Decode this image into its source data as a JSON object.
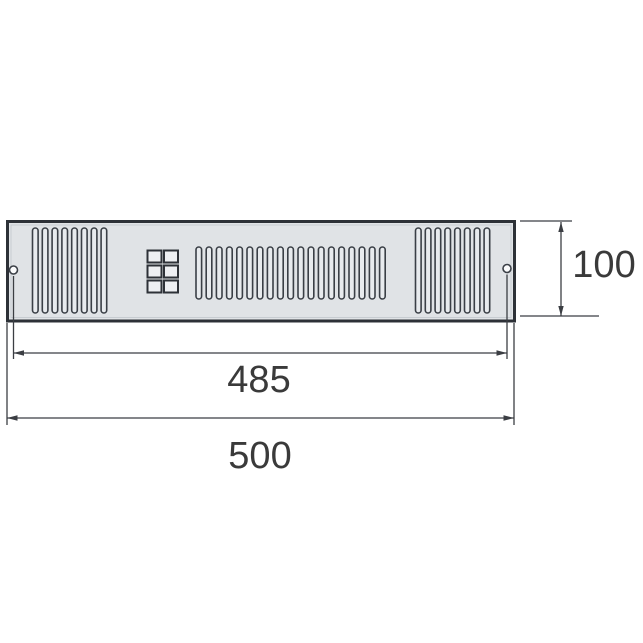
{
  "colors": {
    "background": "#ffffff",
    "panel_fill": "#e0e3e6",
    "panel_stroke": "#2d3137",
    "panel_inner_stroke": "#c7ccd1",
    "slot_fill": "#e8ebee",
    "slot_stroke": "#3a3f46",
    "gridcell_fill": "#edeff2",
    "hole_fill": "#fafbfc",
    "dim_line": "#3b3e43",
    "dim_text": "#3a3a3a"
  },
  "drawing": {
    "type": "technical-drawing",
    "subject": "slotted-vent-grille-panel",
    "dimension_labels": {
      "overall_width": "500",
      "hole_spacing": "485",
      "height": "100"
    },
    "vent_groups": [
      {
        "position": "left",
        "slot_count": 8
      },
      {
        "position": "center",
        "slot_count": 19
      },
      {
        "position": "right",
        "slot_count": 8
      }
    ],
    "label_grid": {
      "rows": 3,
      "columns": 2
    },
    "screw_holes": {
      "count": 2
    }
  }
}
